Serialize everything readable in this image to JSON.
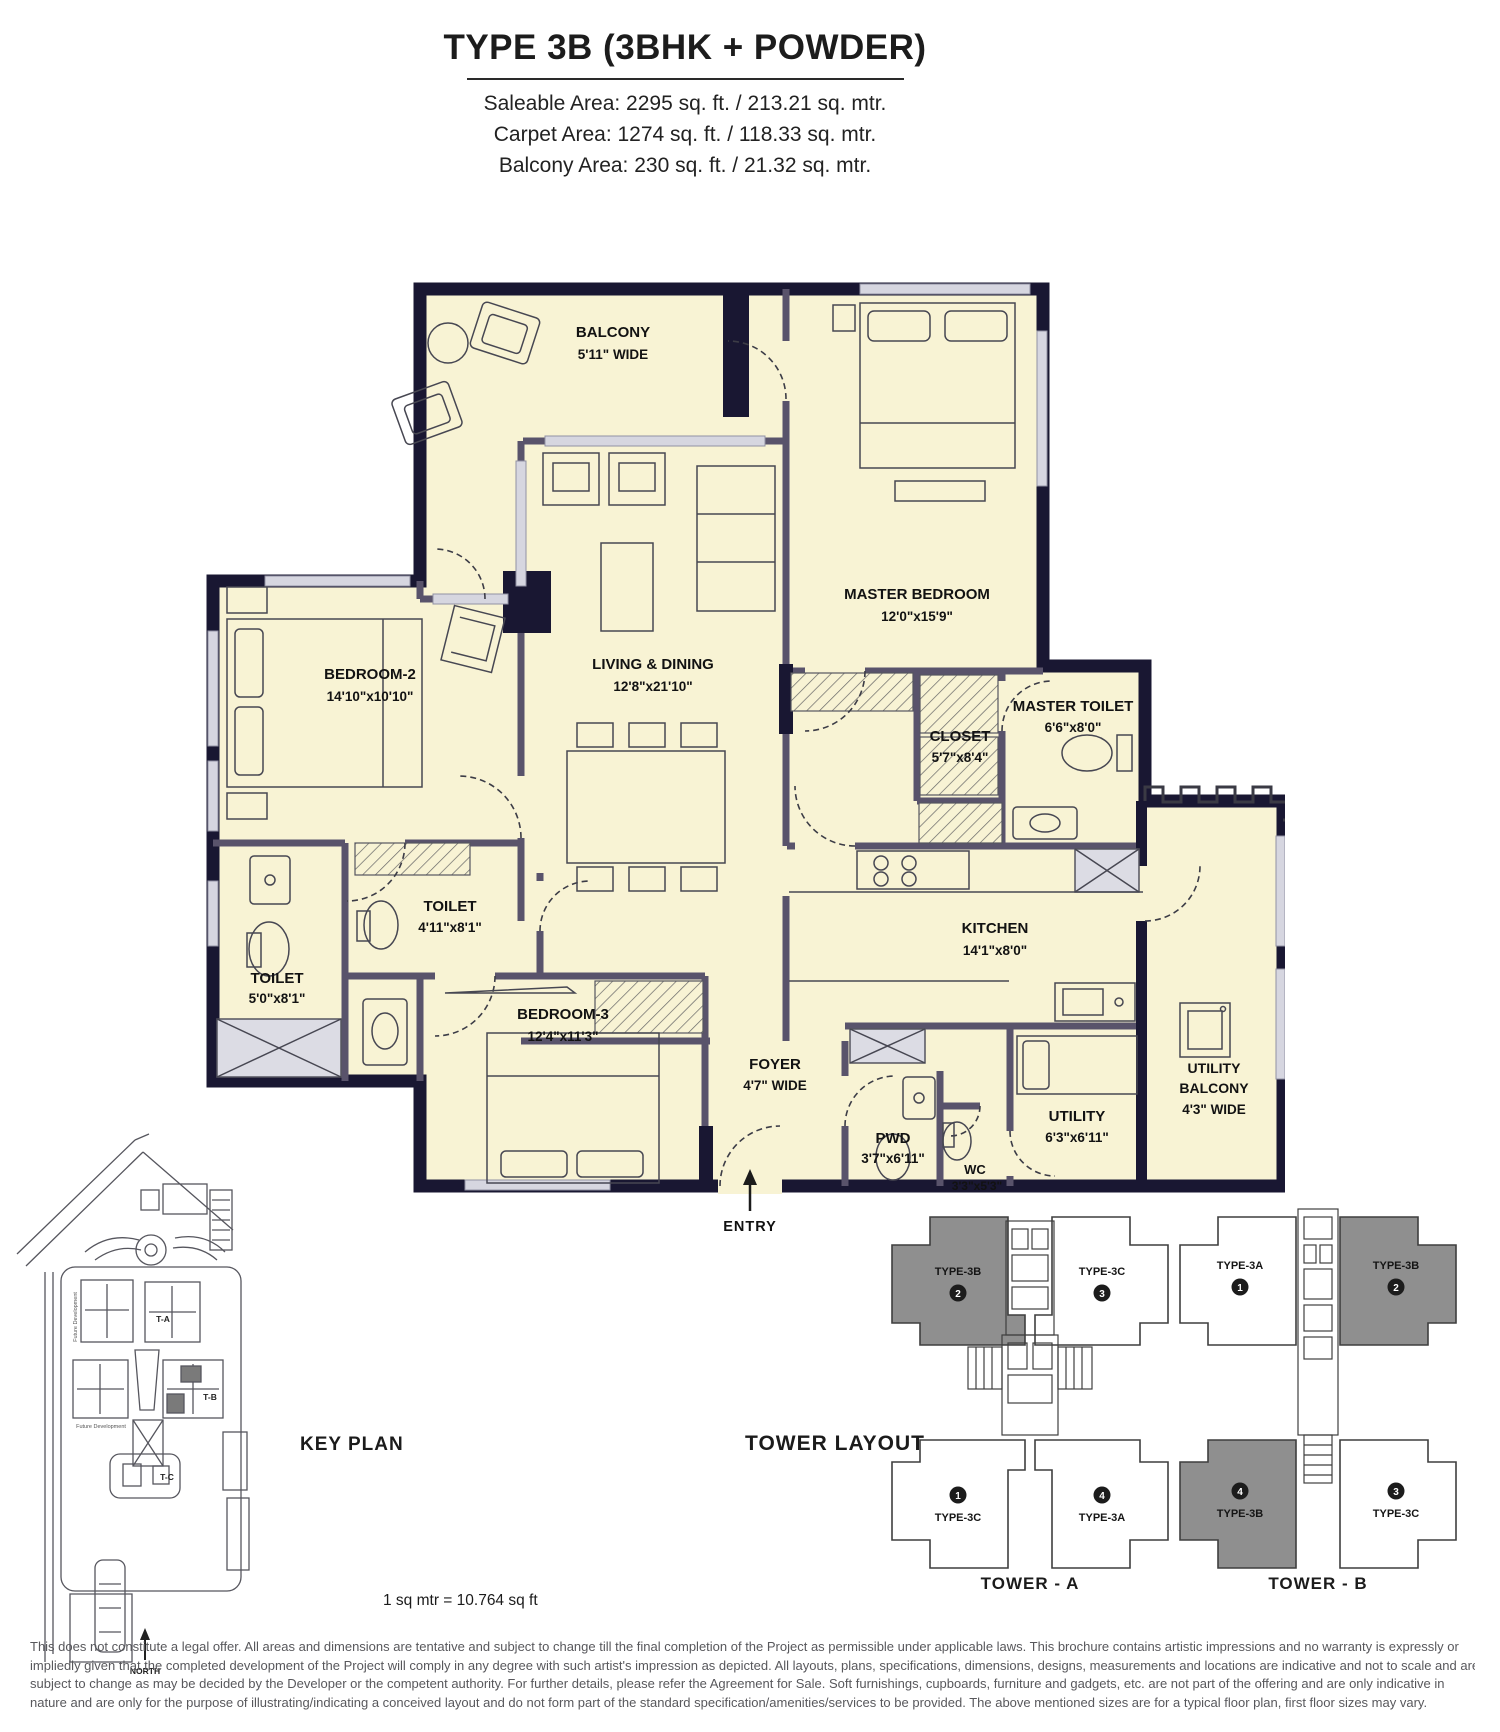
{
  "header": {
    "title": "TYPE 3B (3BHK + POWDER)",
    "area_lines": [
      "Saleable Area: 2295 sq. ft. / 213.21 sq. mtr.",
      "Carpet Area: 1274 sq. ft. / 118.33 sq. mtr.",
      "Balcony Area: 230 sq. ft. / 21.32 sq. mtr."
    ]
  },
  "plan": {
    "rooms": {
      "balcony": {
        "name": "BALCONY",
        "dim": "5'11\" WIDE"
      },
      "master_bedroom": {
        "name": "MASTER BEDROOM",
        "dim": "12'0\"x15'9\""
      },
      "living_dining": {
        "name": "LIVING & DINING",
        "dim": "12'8\"x21'10\""
      },
      "bedroom2": {
        "name": "BEDROOM-2",
        "dim": "14'10\"x10'10\""
      },
      "bedroom3": {
        "name": "BEDROOM-3",
        "dim": "12'4\"x11'3\""
      },
      "master_toilet": {
        "name": "MASTER TOILET",
        "dim": "6'6\"x8'0\""
      },
      "closet": {
        "name": "CLOSET",
        "dim": "5'7\"x8'4\""
      },
      "toilet1": {
        "name": "TOILET",
        "dim": "4'11\"x8'1\""
      },
      "toilet2": {
        "name": "TOILET",
        "dim": "5'0\"x8'1\""
      },
      "kitchen": {
        "name": "KITCHEN",
        "dim": "14'1\"x8'0\""
      },
      "foyer": {
        "name": "FOYER",
        "dim": "4'7\" WIDE"
      },
      "pwd": {
        "name": "PWD",
        "dim": "3'7\"x6'11\""
      },
      "wc": {
        "name": "WC",
        "dim": "3'3\"x5'3\""
      },
      "utility": {
        "name": "UTILITY",
        "dim": "6'3\"x6'11\""
      },
      "utility_balcony": {
        "l1": "UTILITY",
        "l2": "BALCONY",
        "l3": "4'3\" WIDE"
      }
    },
    "entry_label": "ENTRY"
  },
  "key_plan": {
    "label": "KEY PLAN",
    "north_label": "NORTH",
    "t_a": "T-A",
    "t_b": "T-B",
    "t_c": "T-C",
    "future1": "Future Development",
    "future2": "Future Development"
  },
  "tower_layout": {
    "heading": "TOWER LAYOUT",
    "tower_a": {
      "label": "TOWER - A",
      "units": [
        {
          "type": "TYPE-3B",
          "num": "2"
        },
        {
          "type": "TYPE-3C",
          "num": "3"
        },
        {
          "type": "TYPE-3C",
          "num": "1"
        },
        {
          "type": "TYPE-3A",
          "num": "4"
        }
      ]
    },
    "tower_b": {
      "label": "TOWER - B",
      "units": [
        {
          "type": "TYPE-3A",
          "num": "1"
        },
        {
          "type": "TYPE-3B",
          "num": "2"
        },
        {
          "type": "TYPE-3B",
          "num": "4"
        },
        {
          "type": "TYPE-3C",
          "num": "3"
        }
      ]
    }
  },
  "footer": {
    "conversion": "1 sq mtr = 10.764 sq ft",
    "disclaimer": [
      "This does not constitute a legal offer. All areas and dimensions are tentative and subject to change till the final completion of the Project as permissible under applicable laws. This brochure contains artistic impressions and no warranty is expressly or",
      "impliedly given that the completed development of the Project will comply in any degree with such artist's impression as depicted. All layouts, plans, specifications, dimensions, designs, measurements and locations are indicative and not to scale and are",
      "subject to change as may be decided by the Developer or the competent authority. For further details, please refer the Agreement for Sale. Soft furnishings, cupboards, furniture and gadgets, etc. are not part of the offering and are only indicative in",
      "nature and are only for the purpose of illustrating/indicating a conceived layout and do not form part of the standard specification/amenities/services to be provided. The above mentioned sizes are for a typical floor plan, first floor sizes may vary."
    ]
  },
  "colors": {
    "wall_ink": "#191732",
    "wall_inner": "#59536b",
    "room_fill": "#f8f3d4",
    "highlight_unit": "#8f8f8f"
  }
}
